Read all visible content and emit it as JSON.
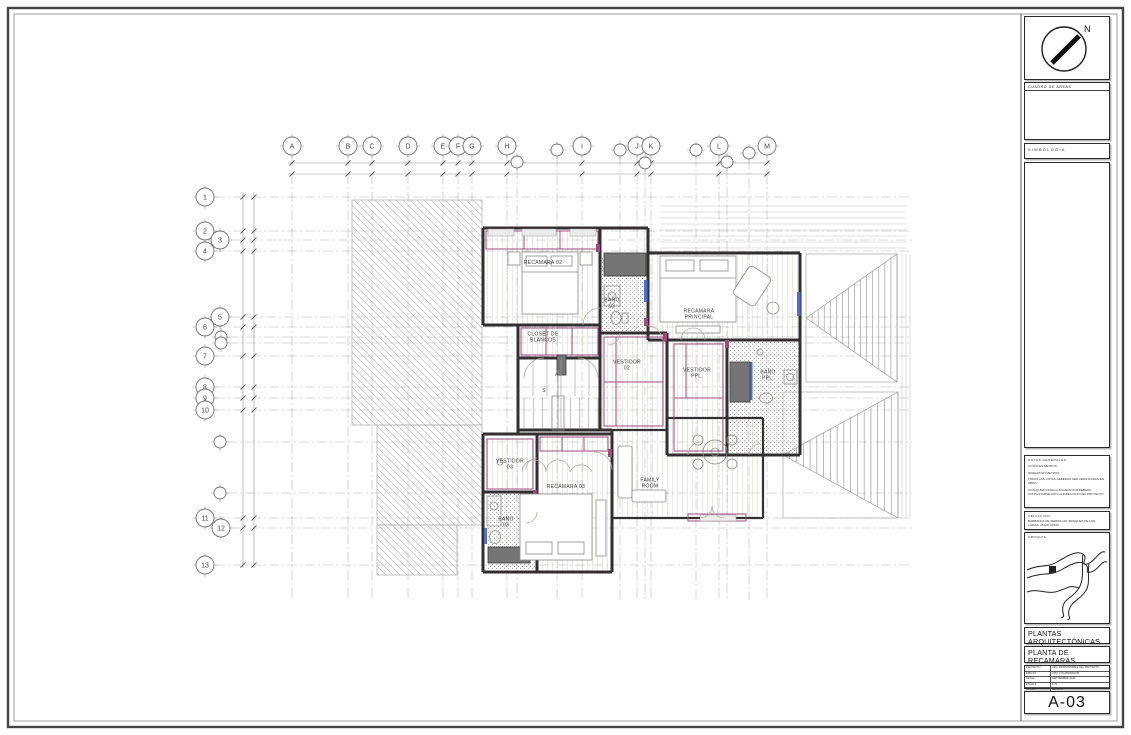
{
  "sheet": {
    "number": "A-03",
    "title_line1": "PLANTAS ARQUITECTÓNICAS",
    "title_line2": "PLANTA DE RECAMARAS"
  },
  "north_label": "N",
  "panels": {
    "areas_header": "CUADRO DE AREAS",
    "simbologia_header": "SIMBOLOGIA",
    "notes_header": "NOTAS GENERALES:",
    "notes": [
      "COTAS EN METROS.",
      "NIVELES EN METROS.",
      "TODAS LAS COTAS DEBERAN SER VERIFICADAS EN OBRA.",
      "CUALQUIER DUDA O ACLARACION DEBERA CONSULTARSE CON LA DIRECCION DEL PROYECTO."
    ],
    "location_header": "UBICACION:",
    "location": "BARRANCA DE SIERRA 115, BOSQUES DE LAS LOMAS, 05120, CDMX.",
    "croquis_header": "CROQUIS:",
    "info_rows": [
      {
        "label": "PROYECTO:",
        "value": "ARQ. RESPONSABLE DEL PROYECTO"
      },
      {
        "label": "DIBUJO:",
        "value": "ARQ. COLABORADOR"
      },
      {
        "label": "FECHA:",
        "value": "SEPTIEMBRE 2020"
      },
      {
        "label": "ESCALA:",
        "value": "1:75"
      },
      {
        "label": "COTAS:",
        "value": "METROS"
      }
    ]
  },
  "grid": {
    "top": [
      {
        "label": "A",
        "x": 292,
        "y": 146,
        "r": 9
      },
      {
        "label": "B",
        "x": 348,
        "y": 146,
        "r": 9
      },
      {
        "label": "C",
        "x": 372,
        "y": 146,
        "r": 9
      },
      {
        "label": "D",
        "x": 408,
        "y": 146,
        "r": 9
      },
      {
        "label": "E",
        "x": 443,
        "y": 146,
        "r": 9
      },
      {
        "label": "F",
        "x": 458,
        "y": 146,
        "r": 9
      },
      {
        "label": "G",
        "x": 472,
        "y": 146,
        "r": 9
      },
      {
        "label": "H",
        "x": 507,
        "y": 146,
        "r": 9
      },
      {
        "label": "",
        "x": 517,
        "y": 162,
        "r": 6
      },
      {
        "label": "",
        "x": 557,
        "y": 150,
        "r": 6
      },
      {
        "label": "I",
        "x": 582,
        "y": 146,
        "r": 9
      },
      {
        "label": "",
        "x": 620,
        "y": 150,
        "r": 6
      },
      {
        "label": "J",
        "x": 637,
        "y": 146,
        "r": 9
      },
      {
        "label": "K",
        "x": 651,
        "y": 146,
        "r": 9
      },
      {
        "label": "",
        "x": 645,
        "y": 163,
        "r": 6
      },
      {
        "label": "",
        "x": 696,
        "y": 150,
        "r": 6
      },
      {
        "label": "L",
        "x": 719,
        "y": 146,
        "r": 9
      },
      {
        "label": "",
        "x": 727,
        "y": 162,
        "r": 6
      },
      {
        "label": "",
        "x": 749,
        "y": 153,
        "r": 6
      },
      {
        "label": "M",
        "x": 767,
        "y": 146,
        "r": 9
      }
    ],
    "left": [
      {
        "label": "1",
        "x": 205,
        "y": 197,
        "r": 9
      },
      {
        "label": "2",
        "x": 205,
        "y": 231,
        "r": 9
      },
      {
        "label": "3",
        "x": 220,
        "y": 240,
        "r": 9
      },
      {
        "label": "4",
        "x": 205,
        "y": 251,
        "r": 9
      },
      {
        "label": "5",
        "x": 220,
        "y": 317,
        "r": 9
      },
      {
        "label": "6",
        "x": 205,
        "y": 327,
        "r": 9
      },
      {
        "label": "",
        "x": 221,
        "y": 337,
        "r": 6
      },
      {
        "label": "",
        "x": 221,
        "y": 343,
        "r": 6
      },
      {
        "label": "7",
        "x": 205,
        "y": 356,
        "r": 9
      },
      {
        "label": "8",
        "x": 205,
        "y": 387,
        "r": 9
      },
      {
        "label": "9",
        "x": 205,
        "y": 398,
        "r": 9
      },
      {
        "label": "10",
        "x": 205,
        "y": 410,
        "r": 9
      },
      {
        "label": "",
        "x": 220,
        "y": 442,
        "r": 6
      },
      {
        "label": "",
        "x": 220,
        "y": 493,
        "r": 6
      },
      {
        "label": "11",
        "x": 205,
        "y": 518,
        "r": 9
      },
      {
        "label": "12",
        "x": 221,
        "y": 528,
        "r": 9
      },
      {
        "label": "13",
        "x": 205,
        "y": 565,
        "r": 9
      }
    ]
  },
  "plan": {
    "rooms": [
      {
        "label": "RECAMARA 02",
        "x": 543,
        "y": 264
      },
      {
        "label": "BAÑO\n02",
        "x": 612,
        "y": 304
      },
      {
        "label": "RECAMARA\nPRINCIPAL",
        "x": 699,
        "y": 315
      },
      {
        "label": "CLOSET DE\nBLANCOS",
        "x": 543,
        "y": 338
      },
      {
        "label": "VESTIDOR\n02",
        "x": 627,
        "y": 366
      },
      {
        "label": "VESTIDOR\nPPL.",
        "x": 697,
        "y": 374
      },
      {
        "label": "BAÑO\nPPL.",
        "x": 768,
        "y": 376
      },
      {
        "label": "S",
        "x": 544,
        "y": 392
      },
      {
        "label": "VESTIDOR\n03",
        "x": 510,
        "y": 465
      },
      {
        "label": "RECAMARA 03",
        "x": 566,
        "y": 488
      },
      {
        "label": "BAÑO\n03",
        "x": 506,
        "y": 523
      },
      {
        "label": "FAMILY\nROOM",
        "x": 650,
        "y": 484
      }
    ]
  },
  "colors": {
    "accent_magenta": "#a04b80",
    "wall": "#332e30",
    "glazing_blue": "#4a6fd4",
    "hatch_gray": "#bdbdbd"
  }
}
